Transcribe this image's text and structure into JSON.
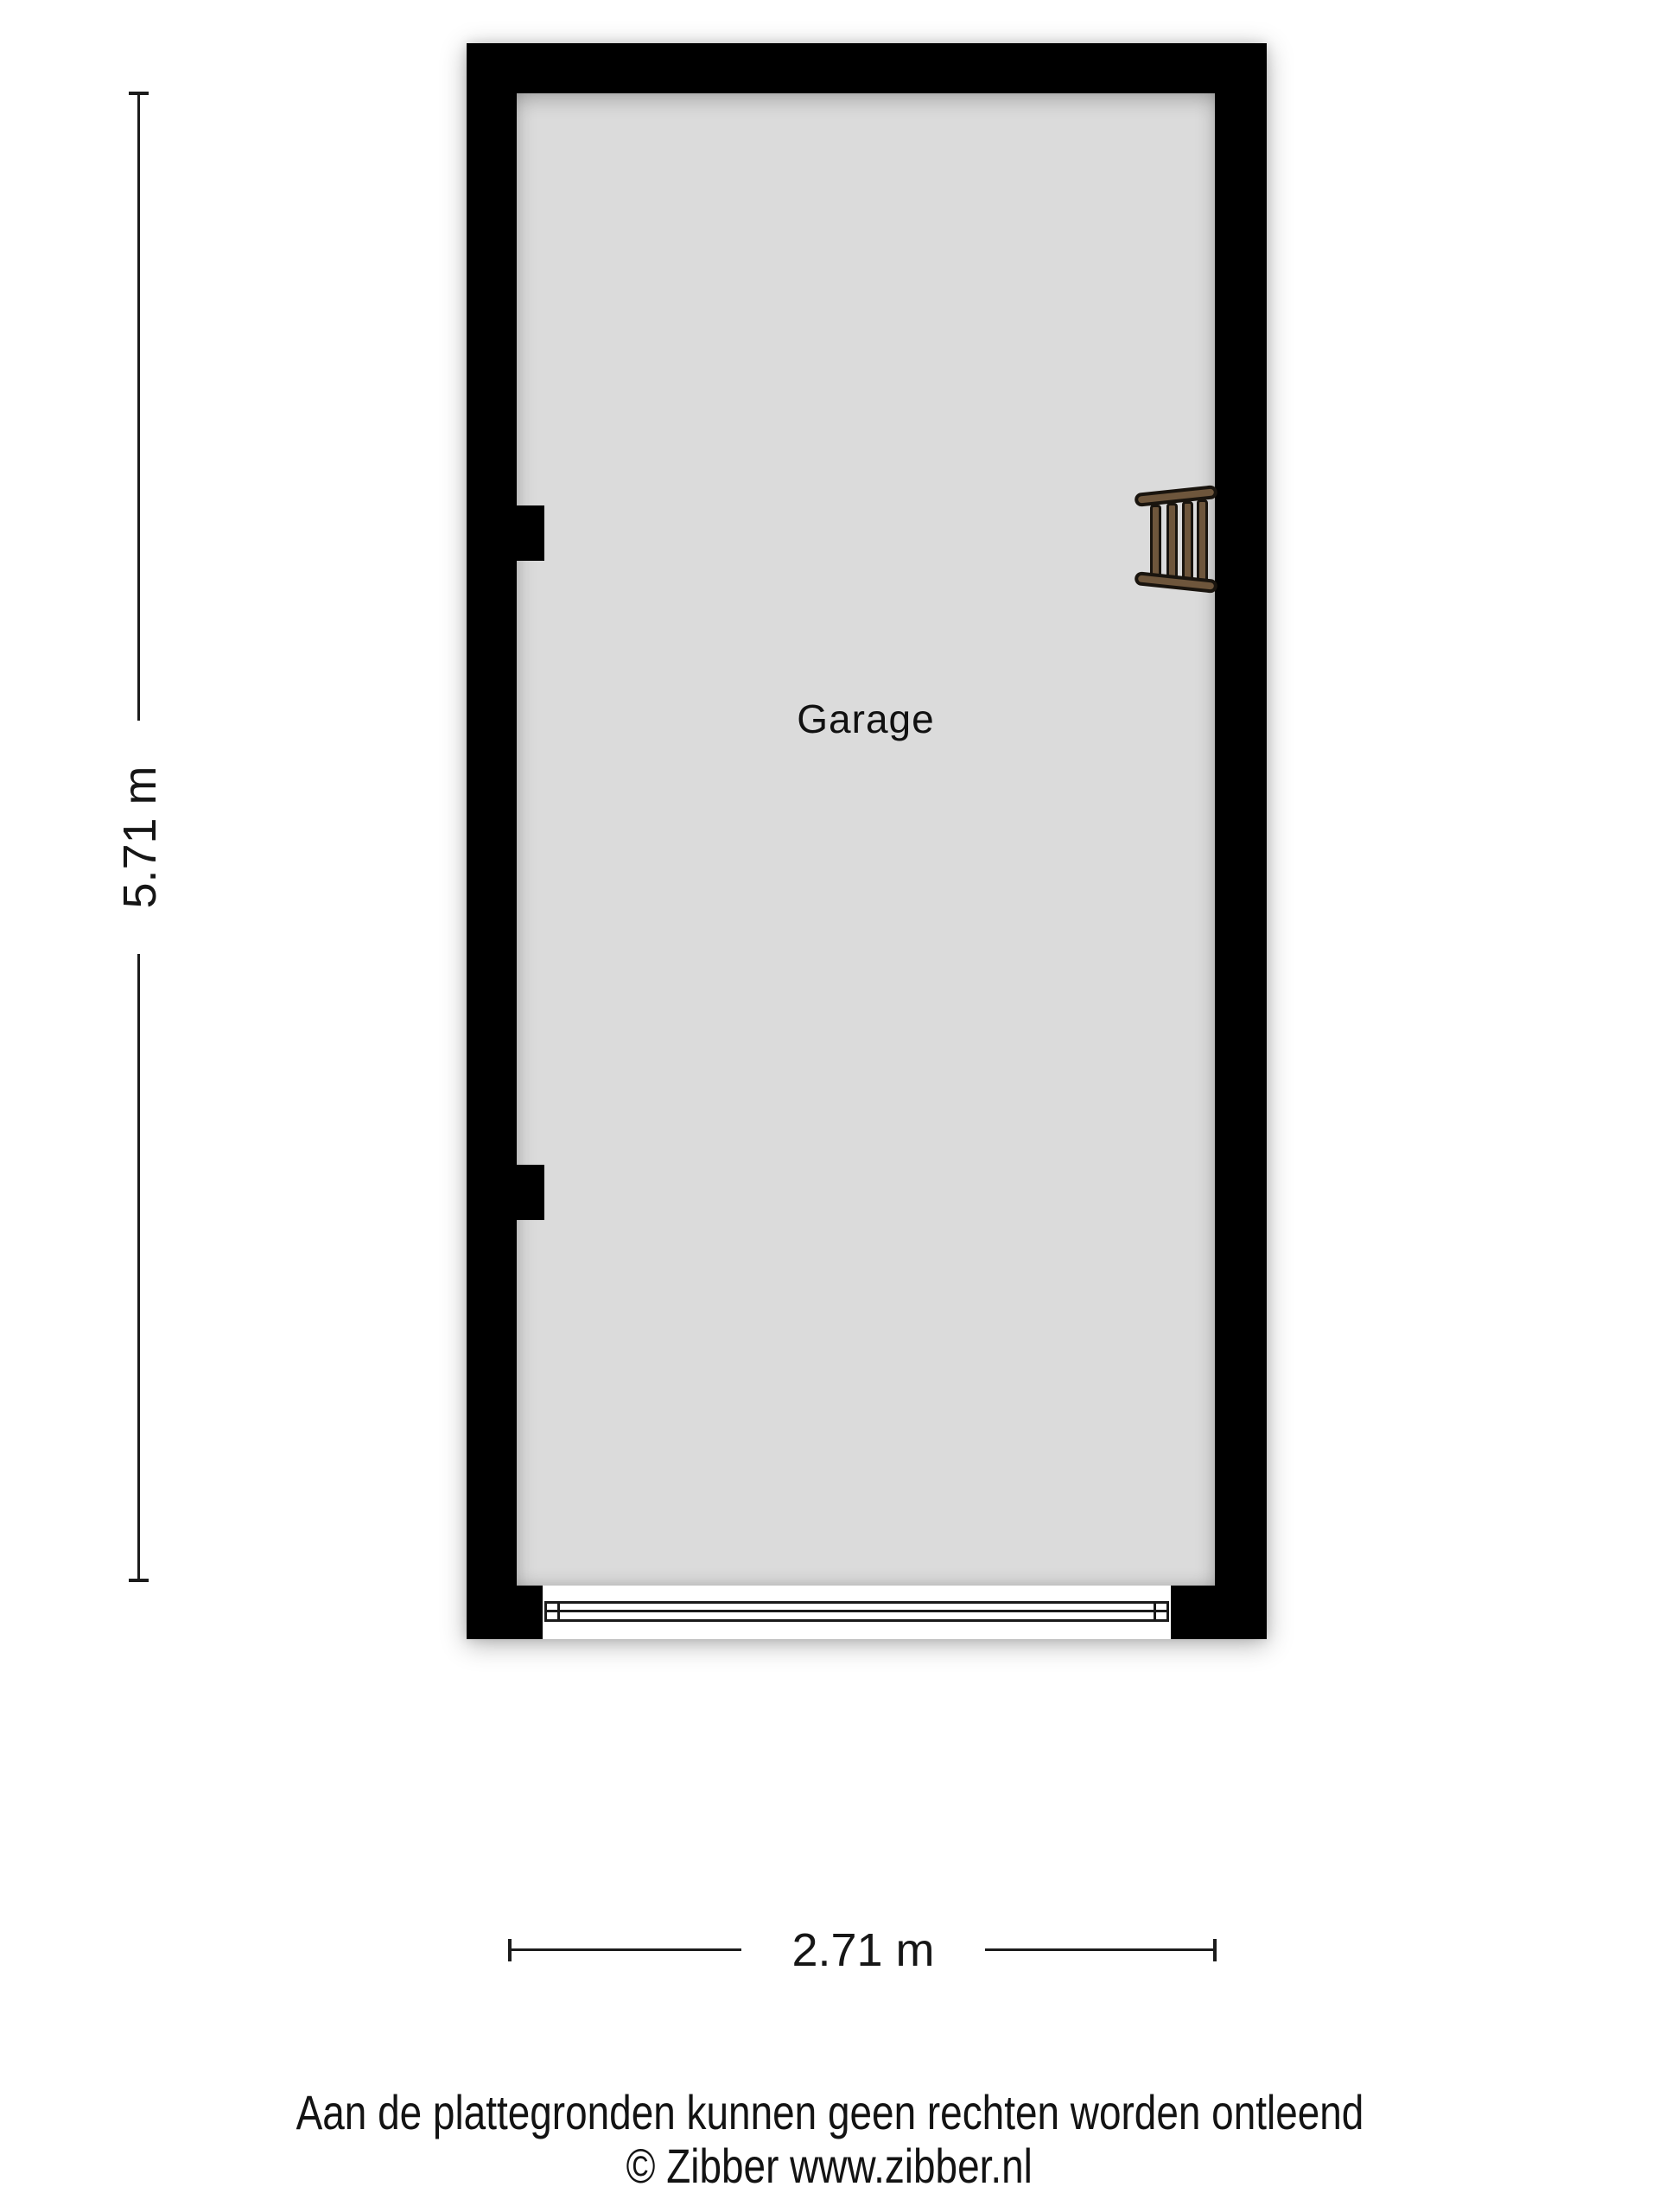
{
  "floorplan": {
    "room": {
      "label": "Garage"
    },
    "dimensions": {
      "vertical": {
        "label": "5.71 m"
      },
      "horizontal": {
        "label": "2.71 m"
      }
    },
    "icons": {
      "ladder": "ladder-icon"
    },
    "colors": {
      "wall": "#000000",
      "floor": "#dbdbdb",
      "dimline": "#1c1c1c",
      "door-line": "#1a1a1a",
      "ladder-wood": "#6e563c",
      "ladder-outline": "#19140e"
    }
  },
  "footer": {
    "disclaimer": "Aan de plattegronden kunnen geen rechten worden ontleend",
    "copyright": "© Zibber www.zibber.nl"
  }
}
